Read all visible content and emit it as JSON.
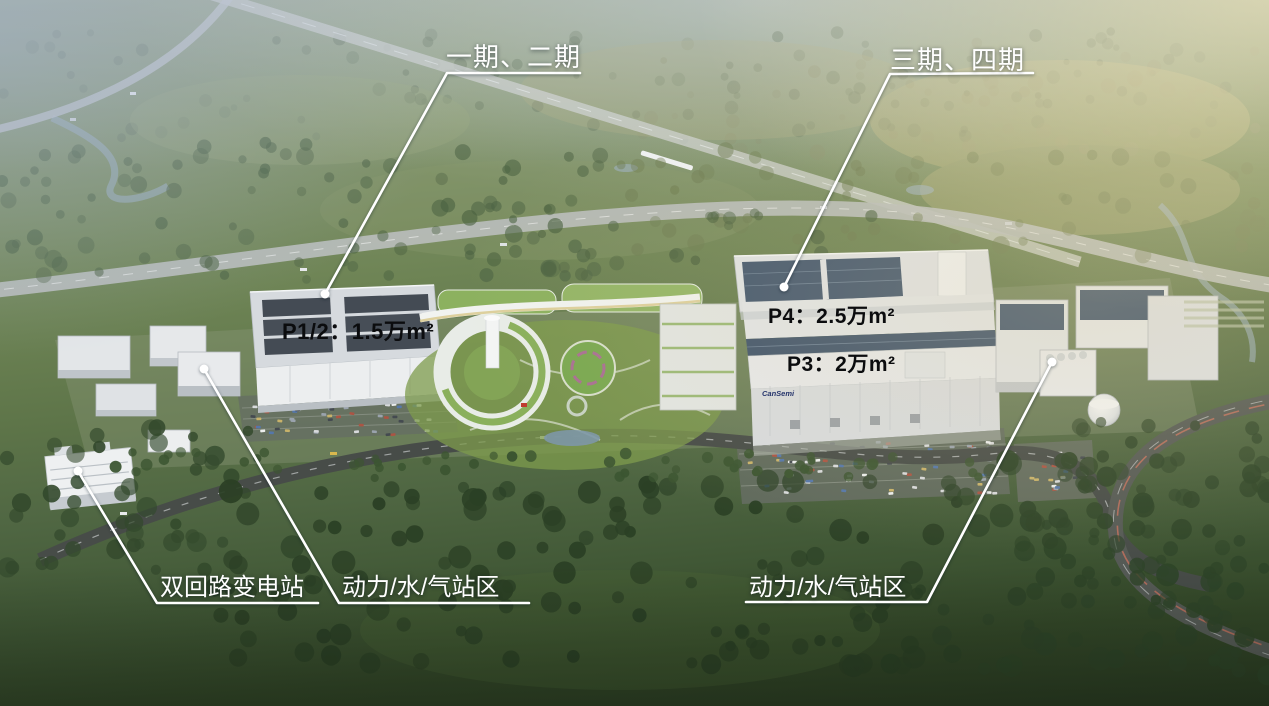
{
  "callouts": {
    "top": [
      {
        "id": "phase-1-2",
        "text": "一期、二期"
      },
      {
        "id": "phase-3-4",
        "text": "三期、四期"
      }
    ],
    "roof": [
      {
        "id": "p1-2",
        "text": "P1/2：1.5万m²"
      },
      {
        "id": "p4",
        "text": "P4：2.5万m²"
      },
      {
        "id": "p3",
        "text": "P3：2万m²"
      }
    ],
    "bottom": [
      {
        "id": "substation",
        "text": "双回路变电站"
      },
      {
        "id": "utility-west",
        "text": "动力/水/气站区"
      },
      {
        "id": "utility-east",
        "text": "动力/水/气站区"
      }
    ],
    "building_logo": "CanSemi"
  },
  "colors": {
    "annotation_line": "#ffffff",
    "top_bottom_label_text": "#ffffff",
    "roof_label_text": "#0b0c0e",
    "solar_panel": "#42566e",
    "green_roof": "#8ab05c",
    "campus_lawn": "#7d9b4c",
    "fab_facade": "#e6e8ea"
  }
}
